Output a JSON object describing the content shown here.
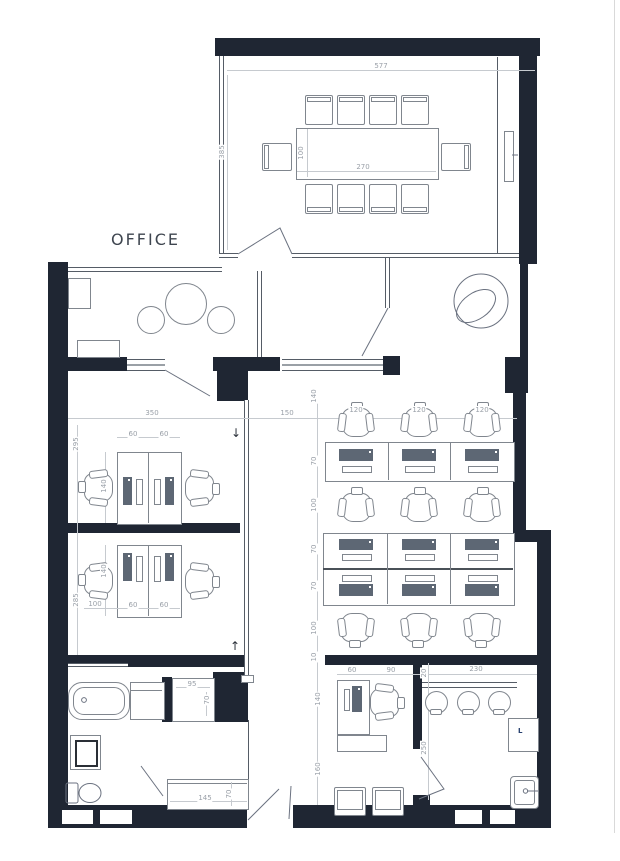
{
  "title": "OFFICE",
  "appliance_label": "L",
  "colors": {
    "wall": "#1f2633",
    "furniture_line": "#80868e",
    "dim_text": "#9aa0a8",
    "monitor": "#5d6774",
    "page_edge": "#d9d9d9"
  },
  "annotations": [
    {
      "t": "577",
      "x": 381,
      "y": 66
    },
    {
      "t": "385",
      "x": 222,
      "y": 152,
      "r": 1
    },
    {
      "t": "100",
      "x": 301,
      "y": 153,
      "r": 1
    },
    {
      "t": "270",
      "x": 363,
      "y": 167
    },
    {
      "t": "350",
      "x": 152,
      "y": 413
    },
    {
      "t": "150",
      "x": 287,
      "y": 413
    },
    {
      "t": "120",
      "x": 356,
      "y": 410
    },
    {
      "t": "120",
      "x": 419,
      "y": 410
    },
    {
      "t": "120",
      "x": 482,
      "y": 410
    },
    {
      "t": "140",
      "x": 314,
      "y": 396,
      "r": 1
    },
    {
      "t": "70",
      "x": 314,
      "y": 461,
      "r": 1
    },
    {
      "t": "100",
      "x": 314,
      "y": 505,
      "r": 1
    },
    {
      "t": "70",
      "x": 314,
      "y": 549,
      "r": 1
    },
    {
      "t": "70",
      "x": 314,
      "y": 586,
      "r": 1
    },
    {
      "t": "100",
      "x": 314,
      "y": 628,
      "r": 1
    },
    {
      "t": "10",
      "x": 314,
      "y": 657,
      "r": 1
    },
    {
      "t": "140",
      "x": 318,
      "y": 699,
      "r": 1
    },
    {
      "t": "160",
      "x": 318,
      "y": 769,
      "r": 1
    },
    {
      "t": "295",
      "x": 76,
      "y": 444,
      "r": 1
    },
    {
      "t": "285",
      "x": 76,
      "y": 600,
      "r": 1
    },
    {
      "t": "100",
      "x": 95,
      "y": 604
    },
    {
      "t": "60",
      "x": 133,
      "y": 434
    },
    {
      "t": "60",
      "x": 164,
      "y": 434
    },
    {
      "t": "60",
      "x": 133,
      "y": 605
    },
    {
      "t": "60",
      "x": 164,
      "y": 605
    },
    {
      "t": "140",
      "x": 104,
      "y": 486,
      "r": 1
    },
    {
      "t": "140",
      "x": 104,
      "y": 571,
      "r": 1
    },
    {
      "t": "95",
      "x": 192,
      "y": 684
    },
    {
      "t": "70",
      "x": 207,
      "y": 700,
      "r": 1
    },
    {
      "t": "145",
      "x": 205,
      "y": 798
    },
    {
      "t": "70",
      "x": 229,
      "y": 794,
      "r": 1
    },
    {
      "t": "60",
      "x": 352,
      "y": 670
    },
    {
      "t": "90",
      "x": 391,
      "y": 670
    },
    {
      "t": "20",
      "x": 424,
      "y": 673,
      "r": 1
    },
    {
      "t": "230",
      "x": 476,
      "y": 669
    },
    {
      "t": "250",
      "x": 424,
      "y": 748,
      "r": 1
    },
    {
      "t": "↓",
      "x": 236,
      "y": 433,
      "big": 1,
      "n": "arrow-down"
    },
    {
      "t": "↑",
      "x": 235,
      "y": 646,
      "big": 1,
      "n": "arrow-up"
    }
  ],
  "task_chairs": [
    {
      "x": 337,
      "y": 402,
      "rot": 0
    },
    {
      "x": 400,
      "y": 402,
      "rot": 0
    },
    {
      "x": 463,
      "y": 402,
      "rot": 0
    },
    {
      "x": 337,
      "y": 487,
      "rot": 0
    },
    {
      "x": 400,
      "y": 487,
      "rot": 0
    },
    {
      "x": 463,
      "y": 487,
      "rot": 0
    },
    {
      "x": 337,
      "y": 608,
      "rot": 180
    },
    {
      "x": 400,
      "y": 608,
      "rot": 180
    },
    {
      "x": 463,
      "y": 608,
      "rot": 180
    },
    {
      "x": 79,
      "y": 468,
      "rot": -90
    },
    {
      "x": 181,
      "y": 468,
      "rot": 90
    },
    {
      "x": 79,
      "y": 561,
      "rot": -90
    },
    {
      "x": 181,
      "y": 561,
      "rot": 90
    },
    {
      "x": 366,
      "y": 682,
      "rot": 90
    }
  ],
  "conf_chairs": [
    {
      "x": 305,
      "y": 95,
      "rot": 0
    },
    {
      "x": 337,
      "y": 95,
      "rot": 0
    },
    {
      "x": 369,
      "y": 95,
      "rot": 0
    },
    {
      "x": 401,
      "y": 95,
      "rot": 0
    },
    {
      "x": 305,
      "y": 184,
      "rot": 180
    },
    {
      "x": 337,
      "y": 184,
      "rot": 180
    },
    {
      "x": 369,
      "y": 184,
      "rot": 180
    },
    {
      "x": 401,
      "y": 184,
      "rot": 180
    },
    {
      "x": 263,
      "y": 142,
      "rot": -90
    },
    {
      "x": 442,
      "y": 142,
      "rot": 90
    }
  ],
  "stools": [
    {
      "x": 425,
      "y": 691
    },
    {
      "x": 457,
      "y": 691
    },
    {
      "x": 488,
      "y": 691
    }
  ]
}
